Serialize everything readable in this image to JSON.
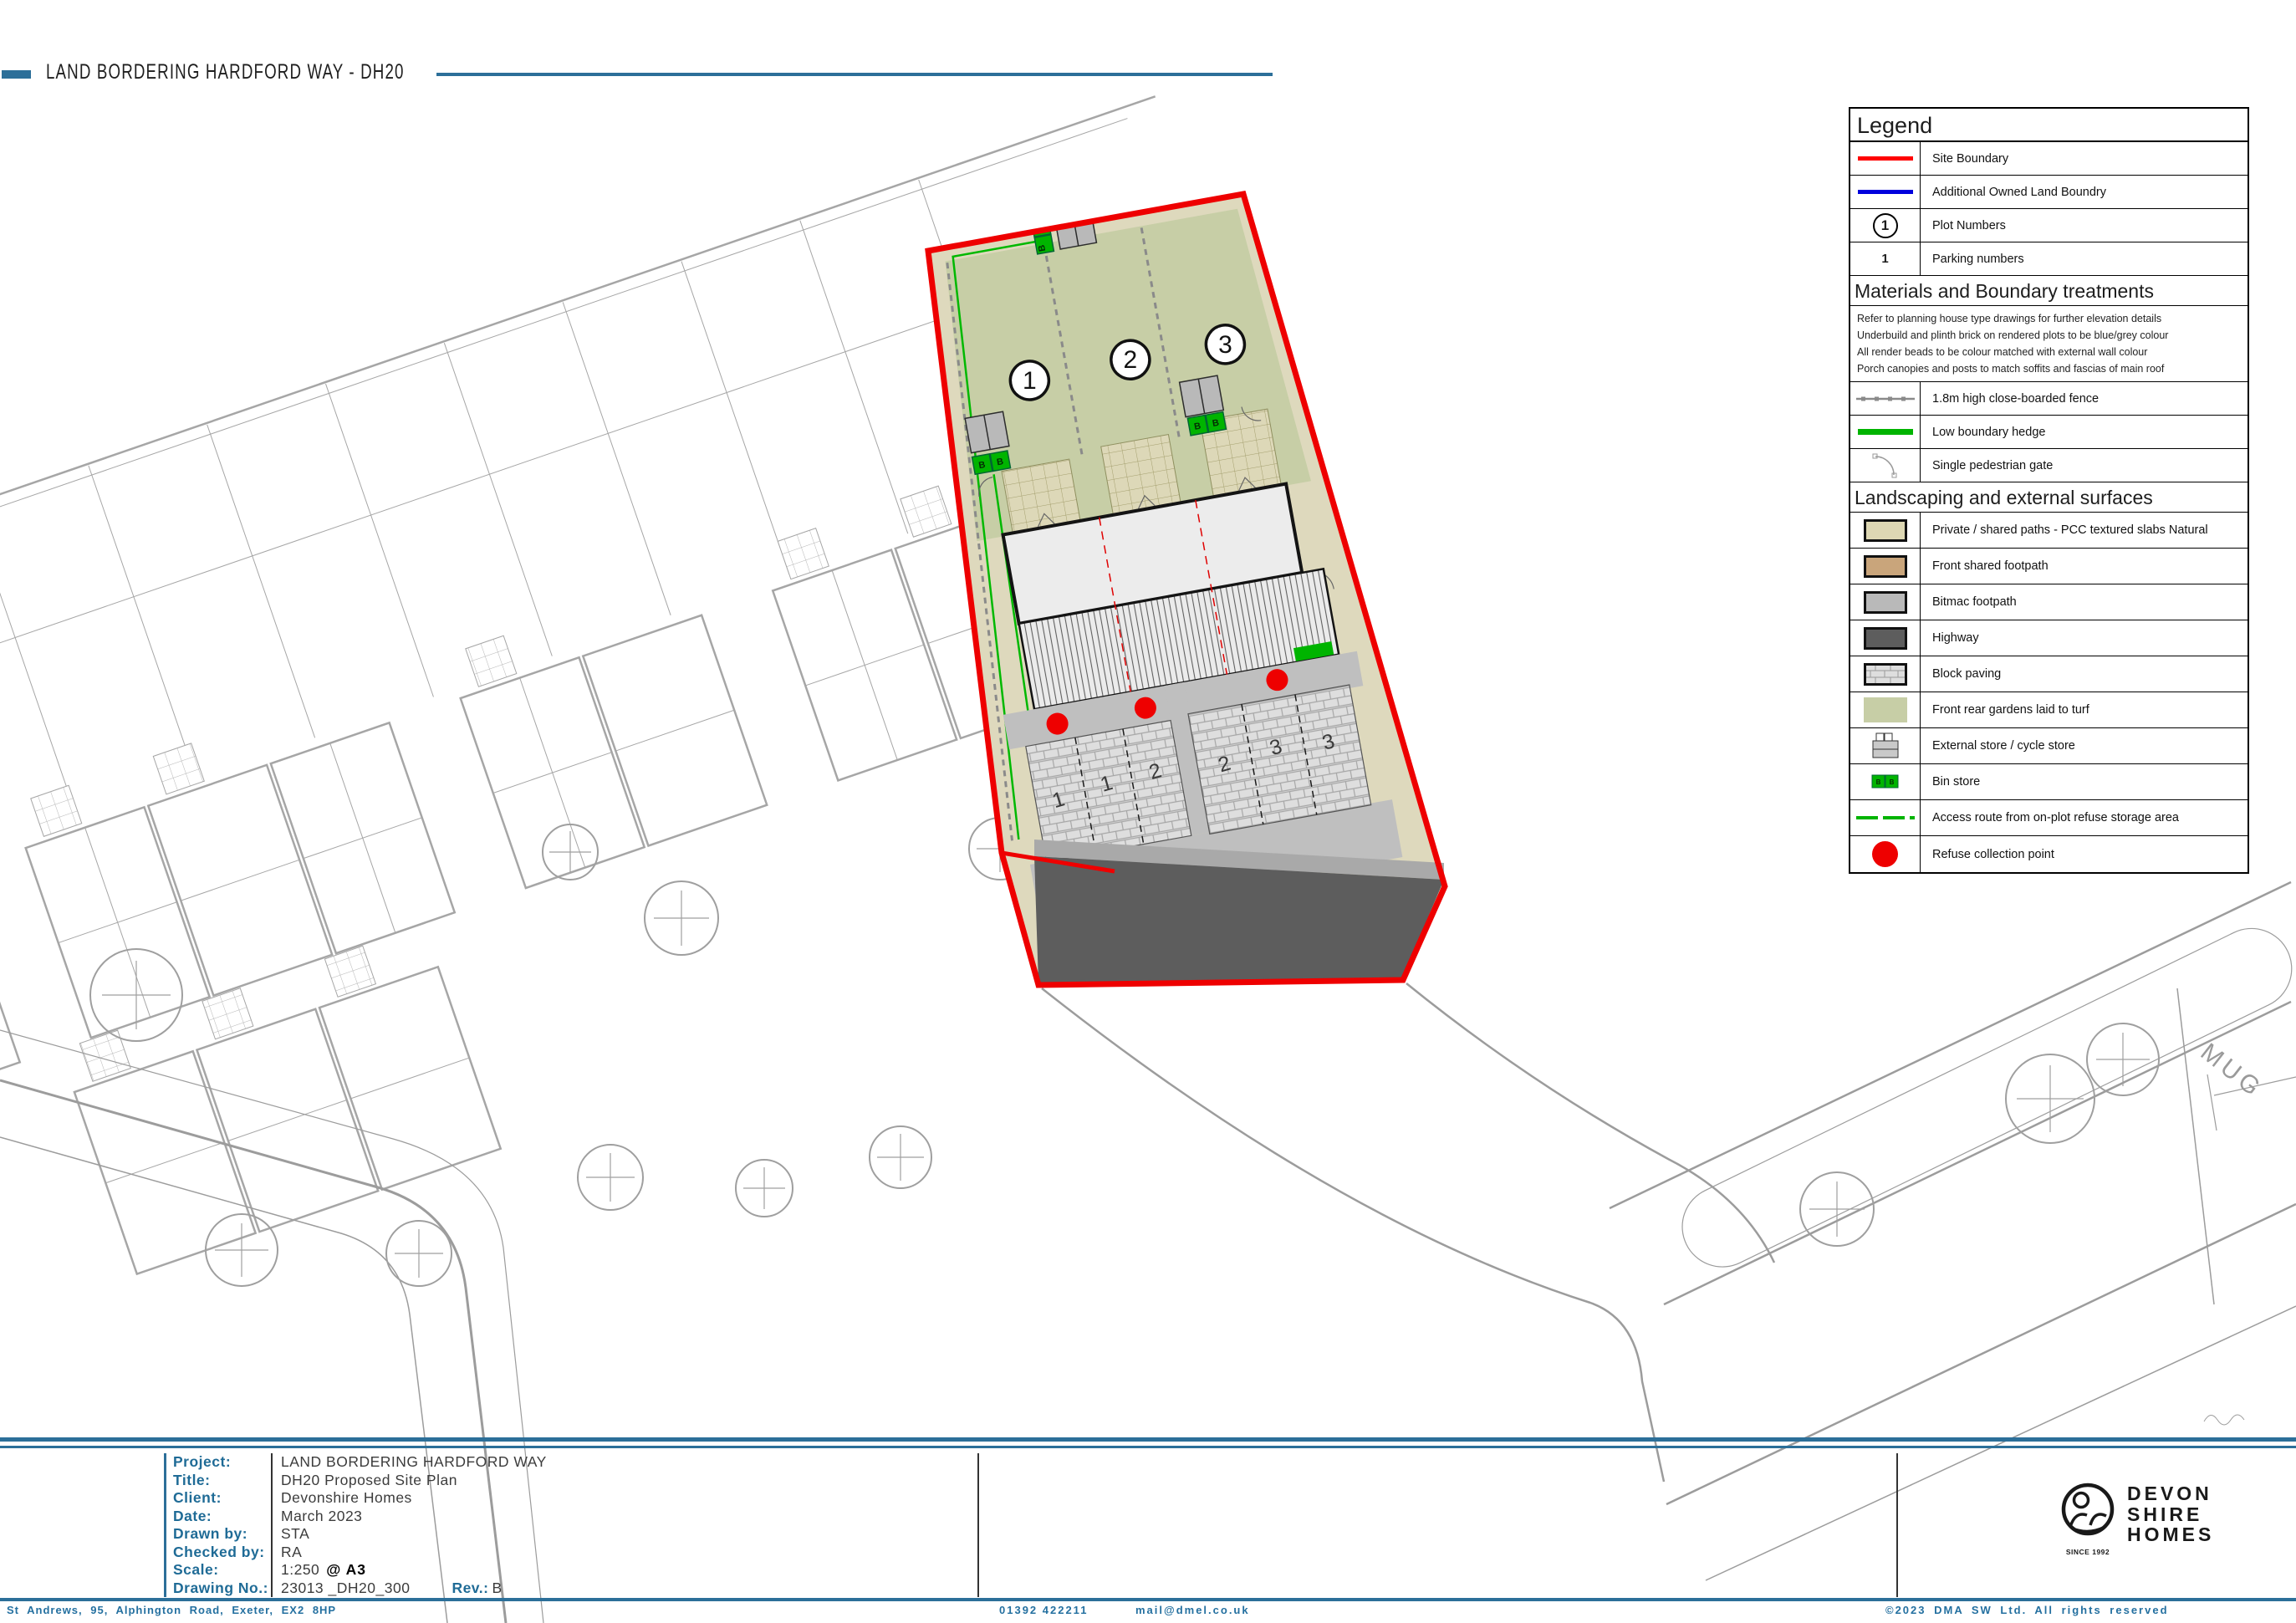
{
  "page": {
    "title": "LAND BORDERING HARDFORD WAY - DH20"
  },
  "legend": {
    "title": "Legend",
    "items": [
      {
        "symbol": "red-line",
        "label": "Site Boundary"
      },
      {
        "symbol": "blue-line",
        "label": "Additional Owned Land Boundry"
      },
      {
        "symbol": "plot-number-circle",
        "symbol_text": "1",
        "label": "Plot Numbers"
      },
      {
        "symbol": "parking-number",
        "symbol_text": "1",
        "label": "Parking numbers"
      }
    ],
    "materials": {
      "title": "Materials and Boundary treatments",
      "notes": [
        "Refer to planning house type drawings for further elevation details",
        "Underbuild and plinth brick on rendered plots to be blue/grey colour",
        "All render beads to be colour matched with external wall colour",
        "Porch canopies and posts to match soffits and fascias of main roof"
      ],
      "items": [
        {
          "symbol": "grey-dashed-fence",
          "label": "1.8m high close-boarded fence"
        },
        {
          "symbol": "green-line",
          "label": "Low boundary hedge"
        },
        {
          "symbol": "gate-arc",
          "label": "Single pedestrian gate"
        }
      ]
    },
    "landscaping": {
      "title": "Landscaping and external surfaces",
      "items": [
        {
          "symbol": "swatch",
          "swatch": "#ddd7b3",
          "label": "Private / shared paths - PCC textured slabs Natural"
        },
        {
          "symbol": "swatch",
          "swatch": "#c9a57b",
          "label": "Front shared footpath"
        },
        {
          "symbol": "swatch",
          "swatch": "#b9b9b9",
          "label": "Bitmac footpath"
        },
        {
          "symbol": "swatch",
          "swatch": "#5d5d5d",
          "label": "Highway"
        },
        {
          "symbol": "brick-swatch",
          "label": "Block paving"
        },
        {
          "symbol": "swatch-noborder",
          "swatch": "#c7cea6",
          "label": "Front rear gardens laid to turf"
        },
        {
          "symbol": "store-icon",
          "label": "External store / cycle store"
        },
        {
          "symbol": "bin-store-icon",
          "label": "Bin store"
        },
        {
          "symbol": "green-dashed-line",
          "label": "Access route from on-plot refuse storage area"
        },
        {
          "symbol": "red-dot",
          "label": "Refuse collection point"
        }
      ]
    }
  },
  "plan": {
    "plot_numbers": [
      "1",
      "2",
      "3"
    ],
    "parking_numbers": [
      "1",
      "1",
      "2",
      "2",
      "3",
      "3"
    ],
    "bin_store_letter": "B",
    "street_label": "MUG"
  },
  "title_block": {
    "fields": [
      {
        "label": "Project:",
        "value": "LAND BORDERING HARDFORD WAY"
      },
      {
        "label": "Title:",
        "value": "DH20 Proposed Site Plan"
      },
      {
        "label": "Client:",
        "value": "Devonshire Homes"
      },
      {
        "label": "Date:",
        "value": "March 2023"
      },
      {
        "label": "Drawn by:",
        "value": "STA"
      },
      {
        "label": "Checked by:",
        "value": "RA"
      },
      {
        "label": "Scale:",
        "value": "1:250"
      },
      {
        "label": "Drawing No.:",
        "value": "23013 _DH20_300"
      }
    ],
    "scale_suffix": "@ A3",
    "rev_label": "Rev.:",
    "rev_value": "B"
  },
  "logo": {
    "line1": "DEVON",
    "line2": "SHIRE",
    "line3": "HOMES",
    "tagline": "SINCE 1992"
  },
  "footer": {
    "address": "St Andrews, 95, Alphington Road, Exeter, EX2 8HP",
    "phone": "01392 422211",
    "email": "mail@dmel.co.uk",
    "copyright": "©2023 DMA SW Ltd. All rights reserved"
  },
  "colors": {
    "brand_blue": "#2c6f99",
    "site_boundary_red": "#ee0000",
    "owned_boundary_blue": "#0000dd",
    "hedge_green": "#00b400",
    "turf_green": "#c7cea6",
    "slab_beige": "#ded9bd",
    "highway_grey": "#5d5d5d",
    "background_linework": "#a6a6a6"
  }
}
